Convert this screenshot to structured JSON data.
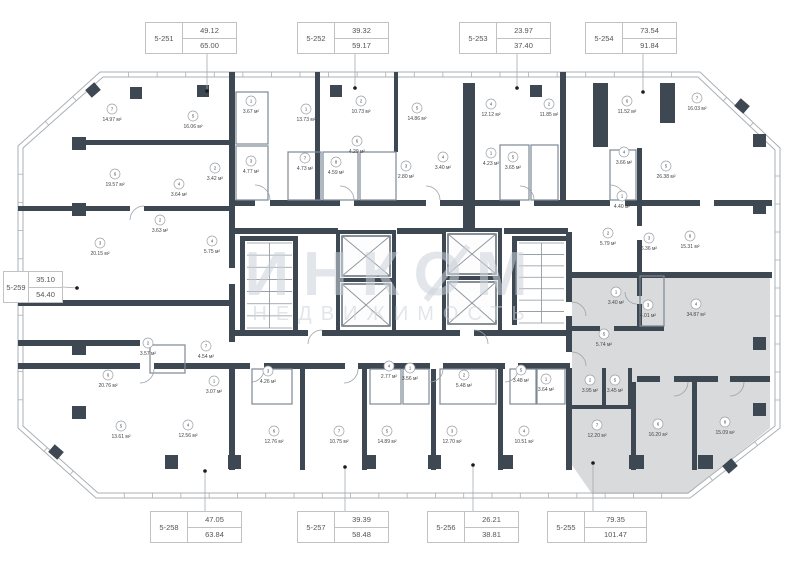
{
  "watermark": {
    "line1": "ИНКОМ",
    "line2": "НЕДВИЖИМОСТЬ"
  },
  "area_unit": "м²",
  "selected_unit": "5-255",
  "units": {
    "top": [
      {
        "id": "5-251",
        "living": "49.12",
        "total": "65.00"
      },
      {
        "id": "5-252",
        "living": "39.32",
        "total": "59.17"
      },
      {
        "id": "5-253",
        "living": "23.97",
        "total": "37.40"
      },
      {
        "id": "5-254",
        "living": "73.54",
        "total": "91.84"
      }
    ],
    "left": [
      {
        "id": "5-259",
        "living": "35.10",
        "total": "54.40"
      }
    ],
    "bottom": [
      {
        "id": "5-258",
        "living": "47.05",
        "total": "63.84"
      },
      {
        "id": "5-257",
        "living": "39.39",
        "total": "58.48"
      },
      {
        "id": "5-256",
        "living": "26.21",
        "total": "38.81"
      },
      {
        "id": "5-255",
        "living": "79.35",
        "total": "101.47"
      }
    ]
  },
  "colors": {
    "wall": "#3d4852",
    "selected_fill": "#d9dadb",
    "watermark": "#ccd3da"
  },
  "rooms": [
    {
      "n": "7",
      "a": "14.97",
      "x": 112,
      "y": 118
    },
    {
      "n": "6",
      "a": "19.57",
      "x": 115,
      "y": 183
    },
    {
      "n": "5",
      "a": "16.06",
      "x": 193,
      "y": 125
    },
    {
      "n": "1",
      "a": "3.67",
      "x": 251,
      "y": 110
    },
    {
      "n": "3",
      "a": "4.77",
      "x": 251,
      "y": 170
    },
    {
      "n": "2",
      "a": "3.42",
      "x": 215,
      "y": 177
    },
    {
      "n": "4",
      "a": "3.64",
      "x": 179,
      "y": 193
    },
    {
      "n": "3",
      "a": "20.15",
      "x": 100,
      "y": 252
    },
    {
      "n": "2",
      "a": "3.63",
      "x": 160,
      "y": 229
    },
    {
      "n": "4",
      "a": "5.75",
      "x": 212,
      "y": 250
    },
    {
      "n": "1",
      "a": "13.73",
      "x": 306,
      "y": 118
    },
    {
      "n": "2",
      "a": "10.73",
      "x": 361,
      "y": 110
    },
    {
      "n": "5",
      "a": "14.86",
      "x": 417,
      "y": 117
    },
    {
      "n": "6",
      "a": "4.29",
      "x": 357,
      "y": 150
    },
    {
      "n": "7",
      "a": "4.73",
      "x": 305,
      "y": 167
    },
    {
      "n": "8",
      "a": "4.59",
      "x": 336,
      "y": 171
    },
    {
      "n": "3",
      "a": "2.80",
      "x": 406,
      "y": 175
    },
    {
      "n": "4",
      "a": "3.40",
      "x": 443,
      "y": 166
    },
    {
      "n": "4",
      "a": "12.12",
      "x": 491,
      "y": 113
    },
    {
      "n": "1",
      "a": "4.23",
      "x": 491,
      "y": 162
    },
    {
      "n": "5",
      "a": "3.65",
      "x": 513,
      "y": 166
    },
    {
      "n": "2",
      "a": "11.85",
      "x": 549,
      "y": 113
    },
    {
      "n": "6",
      "a": "11.52",
      "x": 627,
      "y": 110
    },
    {
      "n": "7",
      "a": "16.03",
      "x": 697,
      "y": 107
    },
    {
      "n": "5",
      "a": "26.38",
      "x": 666,
      "y": 175
    },
    {
      "n": "4",
      "a": "3.66",
      "x": 624,
      "y": 161
    },
    {
      "n": "1",
      "a": "4.40",
      "x": 622,
      "y": 205
    },
    {
      "n": "2",
      "a": "5.79",
      "x": 608,
      "y": 242
    },
    {
      "n": "3",
      "a": "6.36",
      "x": 649,
      "y": 247
    },
    {
      "n": "8",
      "a": "15.31",
      "x": 690,
      "y": 245
    },
    {
      "n": "6",
      "a": "20.76",
      "x": 108,
      "y": 384
    },
    {
      "n": "2",
      "a": "3.57",
      "x": 148,
      "y": 352
    },
    {
      "n": "7",
      "a": "4.54",
      "x": 206,
      "y": 355
    },
    {
      "n": "1",
      "a": "3.07",
      "x": 214,
      "y": 390
    },
    {
      "n": "5",
      "a": "13.61",
      "x": 121,
      "y": 435
    },
    {
      "n": "4",
      "a": "12.56",
      "x": 188,
      "y": 434
    },
    {
      "n": "3",
      "a": "4.26",
      "x": 268,
      "y": 380
    },
    {
      "n": "6",
      "a": "12.76",
      "x": 274,
      "y": 440
    },
    {
      "n": "7",
      "a": "10.75",
      "x": 339,
      "y": 440
    },
    {
      "n": "4",
      "a": "2.77",
      "x": 389,
      "y": 375
    },
    {
      "n": "1",
      "a": "3.56",
      "x": 410,
      "y": 377
    },
    {
      "n": "5",
      "a": "14.89",
      "x": 387,
      "y": 440
    },
    {
      "n": "2",
      "a": "5.48",
      "x": 464,
      "y": 384
    },
    {
      "n": "3",
      "a": "12.70",
      "x": 452,
      "y": 440
    },
    {
      "n": "5",
      "a": "3.48",
      "x": 521,
      "y": 379
    },
    {
      "n": "1",
      "a": "3.64",
      "x": 546,
      "y": 388
    },
    {
      "n": "4",
      "a": "10.51",
      "x": 524,
      "y": 440
    },
    {
      "n": "1",
      "a": "3.40",
      "x": 616,
      "y": 301
    },
    {
      "n": "3",
      "a": "4.01",
      "x": 648,
      "y": 314
    },
    {
      "n": "4",
      "a": "34.87",
      "x": 696,
      "y": 313
    },
    {
      "n": "5",
      "a": "5.74",
      "x": 604,
      "y": 343
    },
    {
      "n": "2",
      "a": "3.95",
      "x": 590,
      "y": 389
    },
    {
      "n": "5",
      "a": "3.45",
      "x": 615,
      "y": 389
    },
    {
      "n": "7",
      "a": "12.20",
      "x": 597,
      "y": 434
    },
    {
      "n": "6",
      "a": "16.20",
      "x": 658,
      "y": 433
    },
    {
      "n": "8",
      "a": "15.09",
      "x": 725,
      "y": 431
    }
  ]
}
